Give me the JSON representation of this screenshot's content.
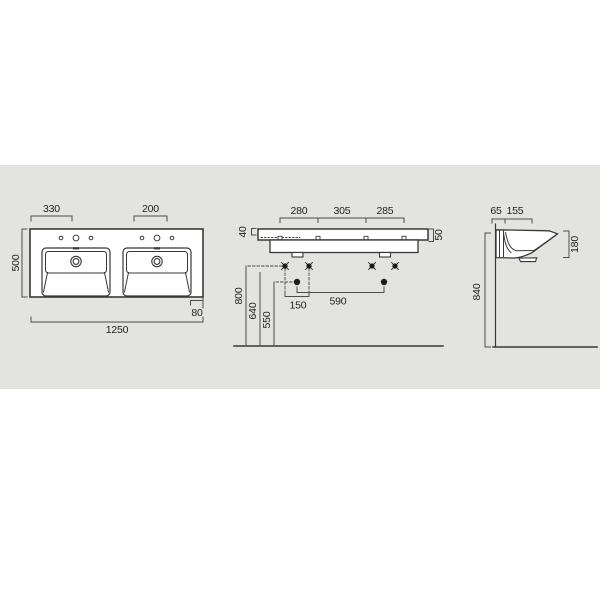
{
  "drawing": {
    "title": "double-washbasin-technical-drawing",
    "colors": {
      "panel": "#e3e4df",
      "object_line": "#383838",
      "dim_line": "#4c4c4c",
      "text": "#1f1f1f",
      "fill": "#ffffff"
    },
    "views": {
      "top": {
        "dims": {
          "left_hole_offset": "330",
          "center_hole_gap": "200",
          "depth": "500",
          "overall_width": "1250",
          "front_edge": "80"
        }
      },
      "front": {
        "dims": {
          "hole_span_left": "280",
          "hole_span_mid": "305",
          "hole_span_right": "285",
          "deck_back_height": "40",
          "deck_front_height": "50",
          "upper_fixing_height": "800",
          "mid_fixing_height": "640",
          "lower_fixing_height": "550",
          "fixing_pitch": "150",
          "fixing_span": "590"
        }
      },
      "side": {
        "dims": {
          "wall_offset": "65",
          "fixing_depth": "155",
          "front_apron_height": "180",
          "mounting_height": "840"
        }
      }
    }
  }
}
